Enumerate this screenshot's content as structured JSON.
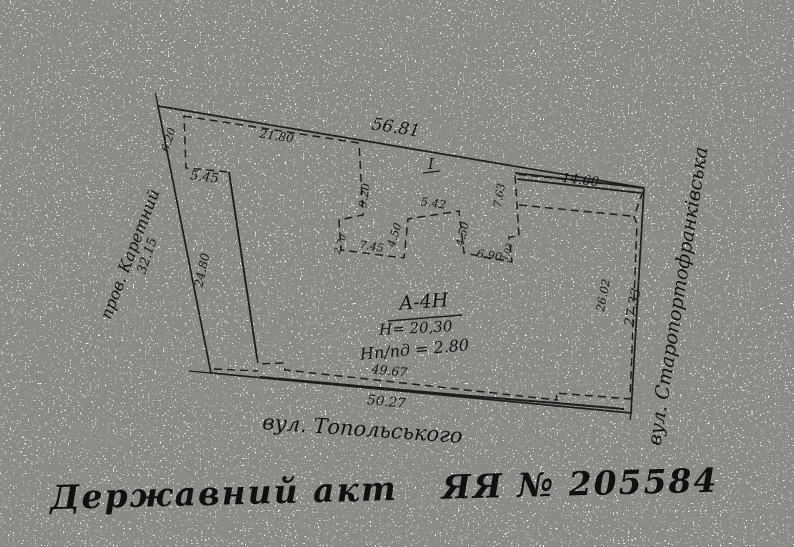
{
  "plan": {
    "dims": {
      "parcel_top": "56.81",
      "parcel_right": "27.33",
      "parcel_bottom": "50.27",
      "parcel_left": "32.15",
      "wing_top_left": "21.80",
      "notch_left_depth": "6.20",
      "notch_left_width": "5.45",
      "wall_left_inner": "24.80",
      "recess_left_side": "9.20",
      "recess_step_left": "2.70",
      "recess_bottom_left": "7.45",
      "court_left_side": "4.50",
      "court_top": "5.42",
      "court_right_side": "4.50",
      "recess_bottom_right": "6.90",
      "recess_step_right": "3.02",
      "wing_right_side": "7.63",
      "wing_top_right": "14.60",
      "wall_right_inner": "26.02",
      "facade_bottom_inner": "49.67"
    },
    "building": {
      "index": "А-4Н",
      "height": "Н= 20,30",
      "basement_height": "Нп/пд = 2.80",
      "section_mark": "I"
    },
    "streets": {
      "left": "пров. Каретний",
      "right": "вул. Старопортофранківська",
      "bottom": "вул. Топольського"
    }
  },
  "footer": {
    "label": "Державний акт",
    "series_number": "ЯЯ № 205584"
  }
}
